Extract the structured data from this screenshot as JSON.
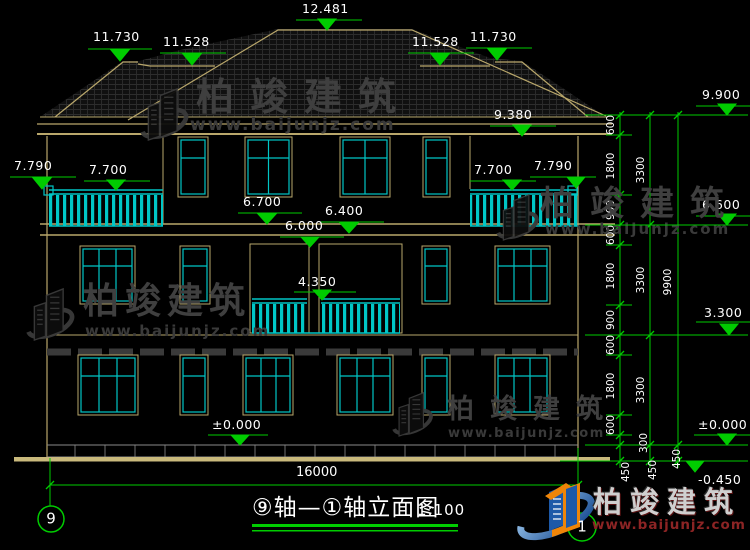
{
  "watermark": {
    "brand": "柏竣建筑",
    "url": "www.baijunjz.com"
  },
  "elevations": {
    "main_ridge": "12.481",
    "side_ridge": "11.730",
    "lower_ridge": "11.528",
    "eave_soffit": "9.380",
    "eave_top": "9.900",
    "balcony_post": "7.790",
    "balcony_rail": "7.700",
    "window_sill_3f": "6.700",
    "band_top": "6.400",
    "band_bottom": "6.000",
    "floor_3": "6.600",
    "balcony_rail_2f": "4.350",
    "floor_2": "3.300",
    "ground": "±0.000",
    "outdoor": "-0.450"
  },
  "dims": {
    "inner": [
      "600",
      "1800",
      "900",
      "600",
      "1800",
      "900",
      "600",
      "1800",
      "600",
      "300",
      "450"
    ],
    "floors": [
      "3300",
      "3300",
      "3300",
      "450"
    ],
    "total": [
      "9900",
      "450"
    ],
    "overall_width": "16000"
  },
  "title_block": {
    "title": "⑨轴—①轴立面图",
    "scale": "1:100",
    "axis_left": "9",
    "axis_right": "1"
  },
  "colors": {
    "wall_tan": "#b9a76b",
    "window_cyan": "#00c6c6",
    "dim_green": "#00cc00",
    "watermark_gray": "#3f3f3f",
    "logo_blue": "#1d59a8",
    "logo_orange": "#ef8508",
    "url_maroon": "#8c2424"
  }
}
